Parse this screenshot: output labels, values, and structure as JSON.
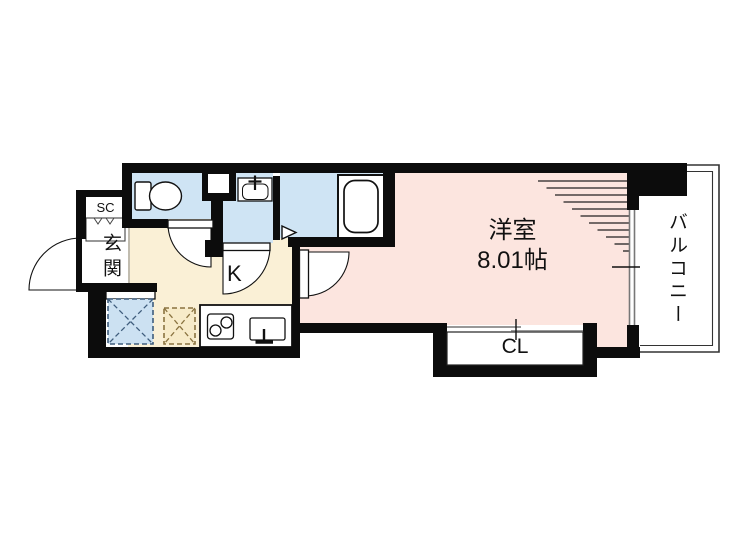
{
  "plan": {
    "labels": {
      "shoe_closet": "SC",
      "entrance": "玄関",
      "kitchen": "K",
      "room_name": "洋室",
      "room_size": "8.01帖",
      "closet": "CL",
      "balcony": "バルコニー"
    },
    "colors": {
      "wall": "#0c0c0c",
      "wet_room": "#cfe4f4",
      "kitchen_floor": "#faf0d6",
      "room_floor": "#fce5df",
      "laundry_space_fill": "#cce1f2",
      "laundry_space_stroke": "#3f5d7d",
      "fridge_space_fill": "#f7ebc9",
      "fridge_space_stroke": "#8a7340",
      "sash_gray": "#777777",
      "balcony_line": "#333333"
    },
    "fixtures": {
      "toilet": "toilet",
      "washbasin": "washbasin",
      "bathtub": "bathtub",
      "stove": "two-burner-stove",
      "kitchen_sink": "kitchen-sink",
      "washing_machine_space": "washing-machine-space",
      "refrigerator_space": "refrigerator-space",
      "pipe_space": "pipe-space"
    }
  }
}
